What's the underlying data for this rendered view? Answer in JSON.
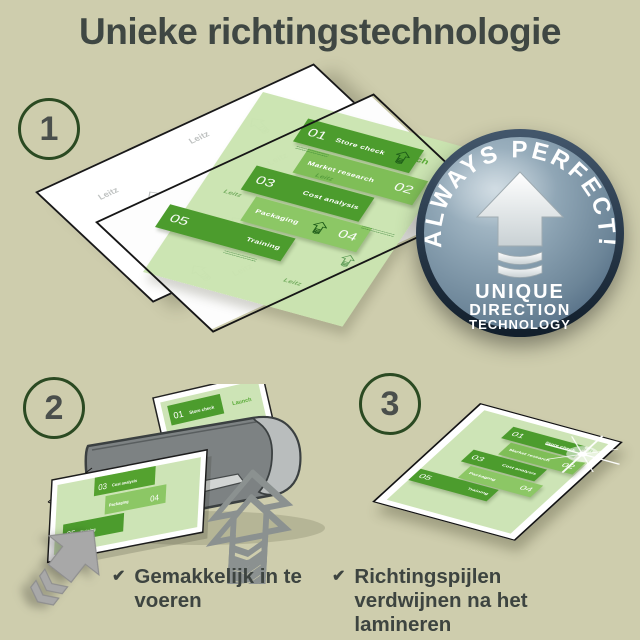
{
  "title": "Unieke richtingstechnologie",
  "steps": [
    {
      "number": "1"
    },
    {
      "number": "2"
    },
    {
      "number": "3"
    }
  ],
  "badge": {
    "arc_text": "ALWAYS PERFECT!",
    "lines": [
      "UNIQUE",
      "DIRECTION",
      "TECHNOLOGY"
    ]
  },
  "document": {
    "launch_label": "Launch",
    "watermark_label": "Leitz",
    "items": [
      {
        "num": "01",
        "label": "Store check"
      },
      {
        "num": "02",
        "label": "Market research"
      },
      {
        "num": "03",
        "label": "Cost analysis"
      },
      {
        "num": "04",
        "label": "Packaging"
      },
      {
        "num": "05",
        "label": "Training"
      }
    ]
  },
  "checklist": [
    {
      "text": "Gemakkelijk in te voeren"
    },
    {
      "text": "Richtingspijlen verdwijnen na het lamineren"
    }
  ],
  "icons": {
    "check": "✔"
  },
  "colors": {
    "background": "#cecdad",
    "title_text": "#3f4743",
    "step_circle_border": "#2b4a22",
    "badge_fill": "#7e97a8",
    "badge_rim": "#1c2c3d",
    "green_dark": "#4c9c2d",
    "green_mid": "#7fbe57",
    "green_light": "#8cc765",
    "sheet_green": "#cde4b6",
    "laminator_gray": "#7d8283",
    "laminator_cap_gray": "#b9bdbd",
    "arrow_gray": "#a8a8a8"
  }
}
